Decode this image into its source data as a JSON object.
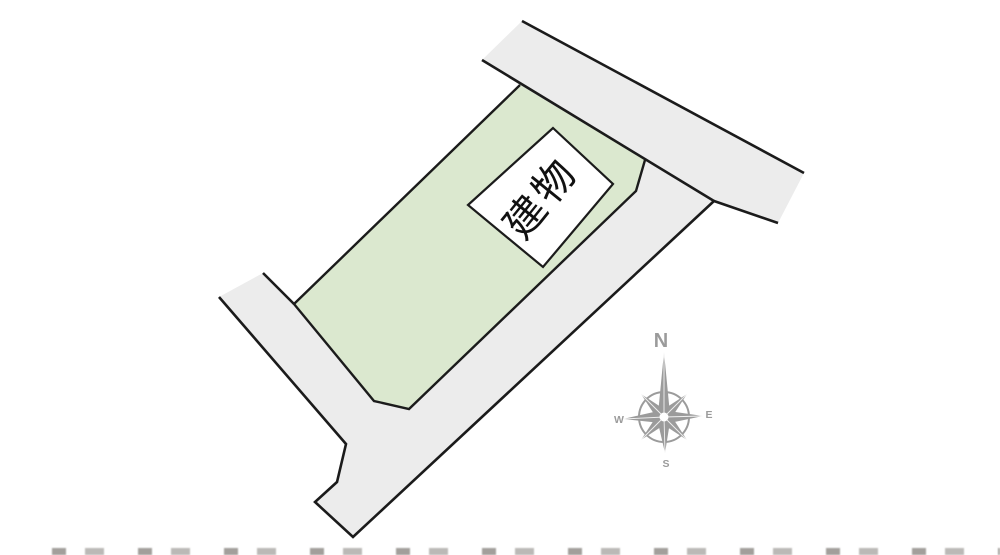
{
  "diagram": {
    "building_label": "建物"
  },
  "compass": {
    "north": "N",
    "east": "E",
    "south": "S",
    "west": "W"
  },
  "colors": {
    "background": "#ffffff",
    "road_fill": "#ececec",
    "plot_fill": "#dbe8cf",
    "outline": "#1b1b1b",
    "building_fill": "#ffffff",
    "building_text": "#111111",
    "compass": "#9b9b9b"
  }
}
